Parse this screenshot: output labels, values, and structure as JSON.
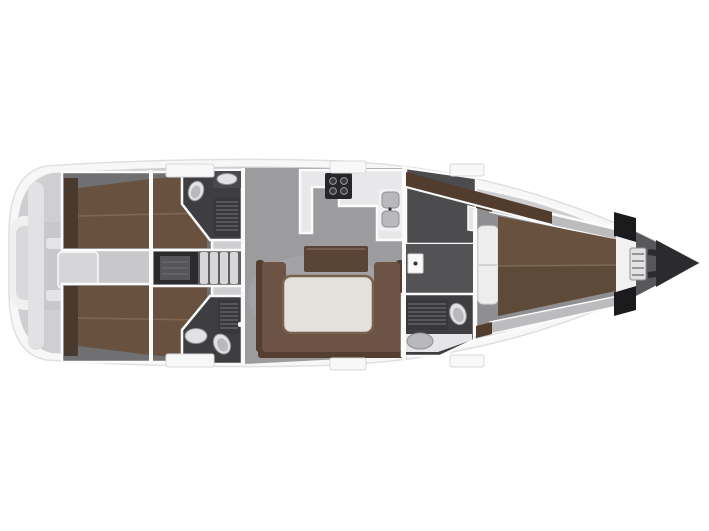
{
  "figure": {
    "subject": "sailing-yacht interior layout plan, top view",
    "orientation": "bow-right-stern-left",
    "visible_rooms": [
      "cockpit",
      "port-aft-cabin",
      "starboard-aft-cabin",
      "port-aft-head",
      "starboard-aft-head",
      "engine-companionway",
      "saloon",
      "galley",
      "navigation-dressing-area",
      "forward-head",
      "forward-owner-cabin",
      "forepeak-anchor-locker"
    ]
  },
  "colors": {
    "page_bg": "#ffffff",
    "hull": "#f7f7f8",
    "hull_stroke": "#e0e0e2",
    "deck": "#cfcfd1",
    "transom_recess": "#f0f0f1",
    "transom_inner": "#d9d9db",
    "stern_seat": "#e2e2e4",
    "cockpit_floor": "#c8c8ca",
    "bench": "#e4e4e6",
    "console": "#d6d6d8",
    "locker_gray": "#c3c3c5",
    "wall": "#fbfbfc",
    "cabin_floor": "#707073",
    "bed_brown": "#68523f",
    "bed_brown_dark": "#5e4a39",
    "bed_seam": "#7e6854",
    "headboard": "#4a392d",
    "head_floor": "#3e3e41",
    "grate_bg": "#38383b",
    "grate_line": "#6a6a6e",
    "fixture_white": "#e2e2e4",
    "fixture_inner": "#b9b9bd",
    "counter_dark": "#4a4a4e",
    "engine_dark": "#2b2b2d",
    "corridor": "#606063",
    "step_light": "#d7d7d9",
    "salon_floor": "#9c9c9f",
    "salon_glow": "#aeaeb1",
    "galley_counter": "#e8e8ea",
    "stove": "#26262a",
    "sink_unit": "#f1f1f3",
    "basin": "#b9b9bc",
    "settee": "#6d5343",
    "settee_back": "#543e2f",
    "sideboard": "#5a4435",
    "table_top": "#e3e1dc",
    "table_edge": "#7a614c",
    "wardrobe_brown": "#513c2e",
    "nav_dark": "#4c4c4f",
    "dressing": "#535356",
    "shelf_step": "#e6e6e8",
    "door_plate": "#fafafa",
    "knob": "#333333",
    "fwd_floor": "#8f8f92",
    "shelf_gray": "#bcbcbe",
    "pillow": "#ededee",
    "bulkhead": "#f2f2f2",
    "locker_black": "#1b1b1d",
    "forepeak": "#58585b",
    "anchor": "#2b2b2d",
    "ladder": "#e2e2e4",
    "hatch": "#f8f8f9",
    "trim": "#fafafa",
    "dot_dark": "#55585b"
  }
}
